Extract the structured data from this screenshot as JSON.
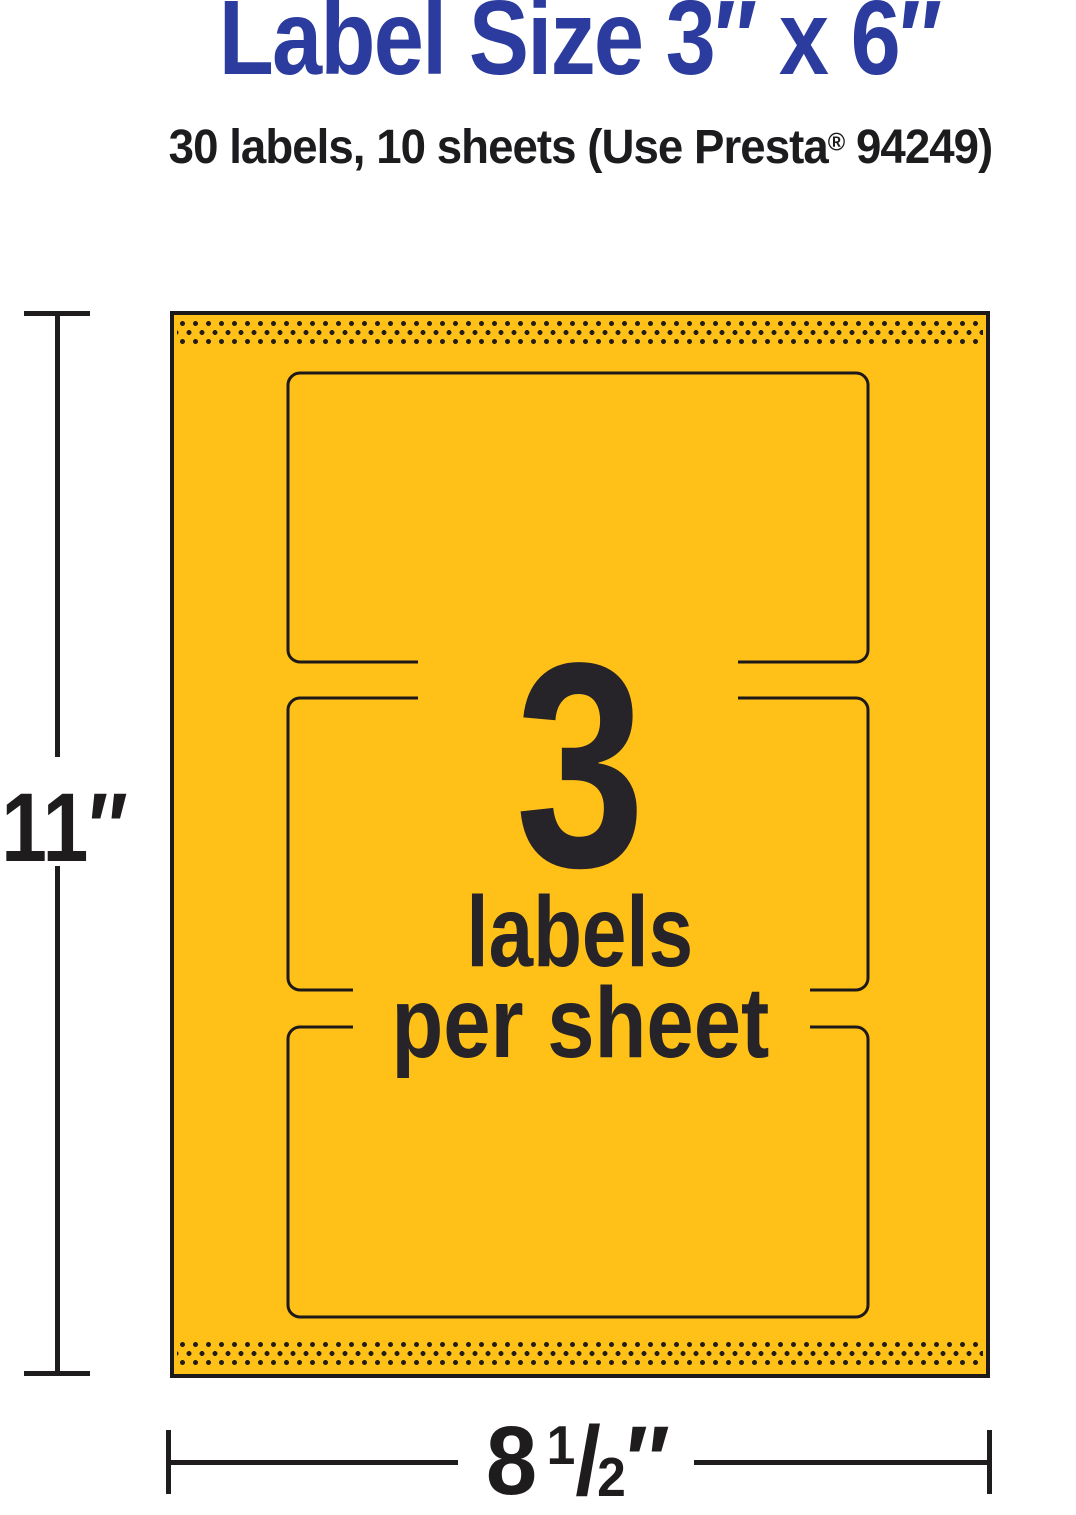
{
  "header": {
    "title": "Label Size 3″ x 6″",
    "subtitle": {
      "prefix": "30 labels, 10 sheets (Use Presta",
      "registered_mark": "®",
      "suffix": " 94249)"
    }
  },
  "sheet": {
    "labels_per_sheet_count": "3",
    "caption_line1": "labels",
    "caption_line2": "per sheet",
    "label_outlines_visible": 3,
    "perforation_bands": [
      "top",
      "bottom"
    ]
  },
  "dimensions": {
    "height_label": "11″",
    "width": {
      "whole": "8",
      "fraction_numerator": "1",
      "fraction_slash": "/",
      "fraction_denominator": "2",
      "unit": "″"
    }
  },
  "colors": {
    "title_blue": "#2b3c9e",
    "paper_yellow": "#ffc117",
    "ink_dark": "#262329",
    "outline_black": "#1d191a",
    "perforation_dot": "#241d14",
    "background": "#ffffff"
  }
}
